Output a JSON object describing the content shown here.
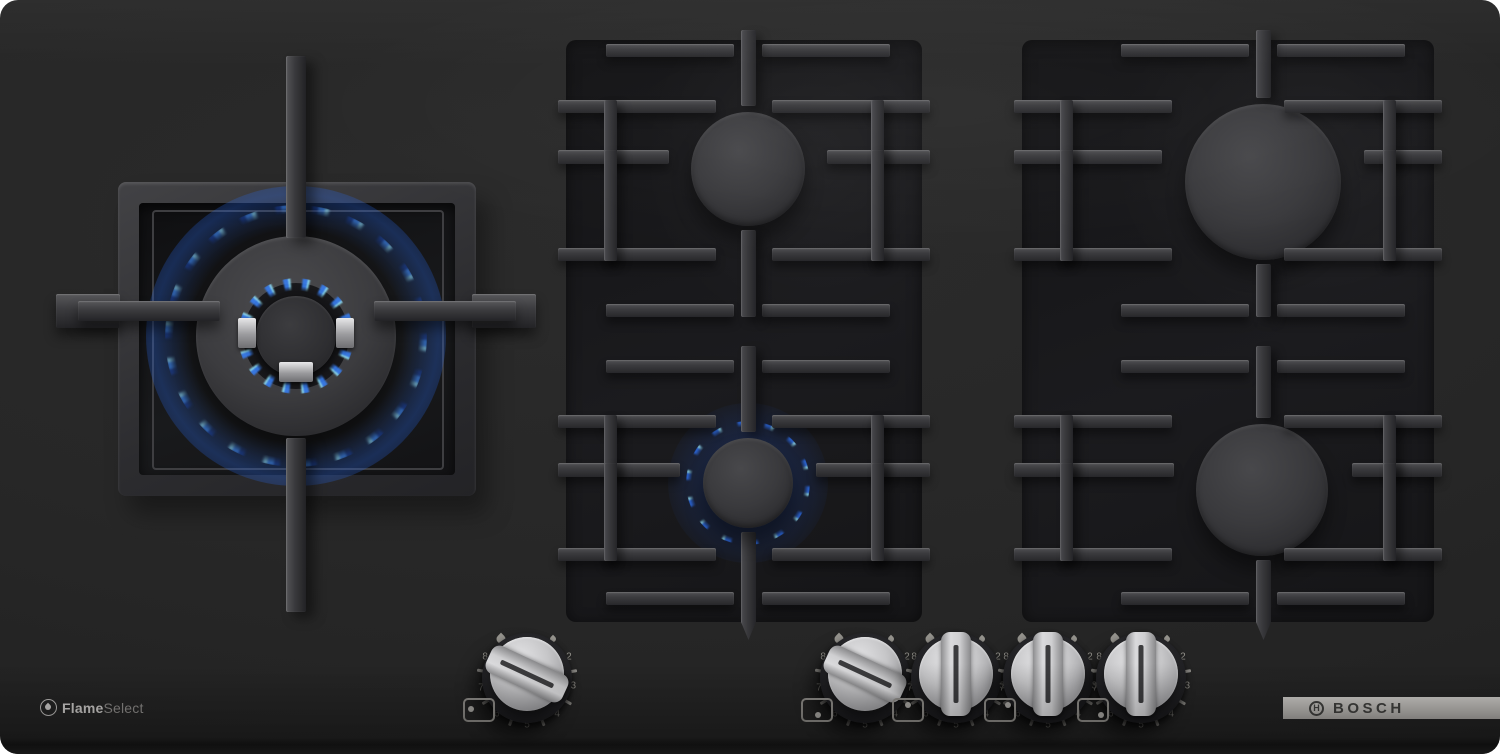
{
  "branding": {
    "logo": "BOSCH",
    "feature_bold": "Flame",
    "feature_light": "Select"
  },
  "burners": [
    {
      "id": "wok-left",
      "position": "left-center",
      "size": "large-dual-ring",
      "lit": true
    },
    {
      "id": "middle-back",
      "position": "middle-top",
      "size": "medium",
      "lit": false
    },
    {
      "id": "middle-front",
      "position": "middle-bottom",
      "size": "small",
      "lit": true
    },
    {
      "id": "right-back",
      "position": "right-top",
      "size": "large",
      "lit": false
    },
    {
      "id": "right-front",
      "position": "right-bottom",
      "size": "large",
      "lit": false
    }
  ],
  "knob_scale": {
    "labels": [
      "2",
      "3",
      "4",
      "5",
      "6",
      "7",
      "8"
    ],
    "label_angles": [
      63,
      100,
      140,
      180,
      220,
      258,
      297
    ],
    "tick_angles": [
      81,
      120,
      160,
      200,
      240,
      279
    ],
    "big_flame_angle": -33,
    "small_flame_angle": 33
  },
  "knobs": [
    {
      "id": "knob-wok",
      "state": "on",
      "angle": -65,
      "dot": "left"
    },
    {
      "id": "knob-middle-front",
      "state": "on",
      "angle": -65,
      "dot": "bottom"
    },
    {
      "id": "knob-middle-back",
      "state": "off",
      "angle": 0,
      "dot": "top"
    },
    {
      "id": "knob-right-back",
      "state": "off",
      "angle": 0,
      "dot": "top-right"
    },
    {
      "id": "knob-right-front",
      "state": "off",
      "angle": 0,
      "dot": "bottom-right"
    }
  ],
  "colors": {
    "surface": "#262626",
    "grate": "#39393c",
    "flame_blue": "#2e7bf0",
    "flame_cyan": "#8fe0f8",
    "knob_silver": "#cbcbcd",
    "logo_bar": "#b6b4b0"
  }
}
